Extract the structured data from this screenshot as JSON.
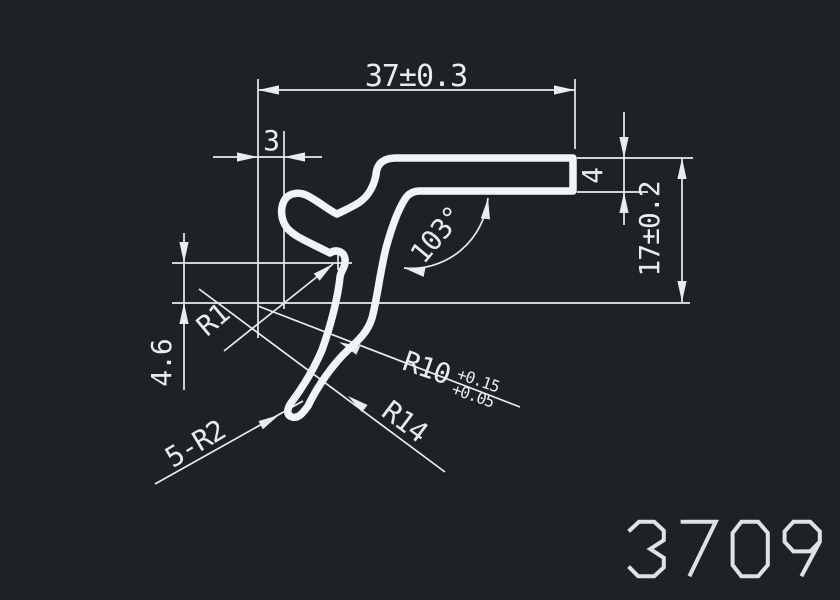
{
  "drawing": {
    "background_color": "#1e2227",
    "line_color": "#edf0f3",
    "part_number": "3709",
    "dimensions": {
      "top_width": "37±0.3",
      "left_offset": "3",
      "right_thickness": "4",
      "right_height": "17±0.2",
      "left_height": "4.6",
      "angle": "103°",
      "fillet_r1": "R1",
      "arc_r10": "R10",
      "arc_r10_tol_upper": "+0.15",
      "arc_r10_tol_lower": "+0.05",
      "arc_r14": "R14",
      "hook_radii": "5-R2"
    }
  }
}
